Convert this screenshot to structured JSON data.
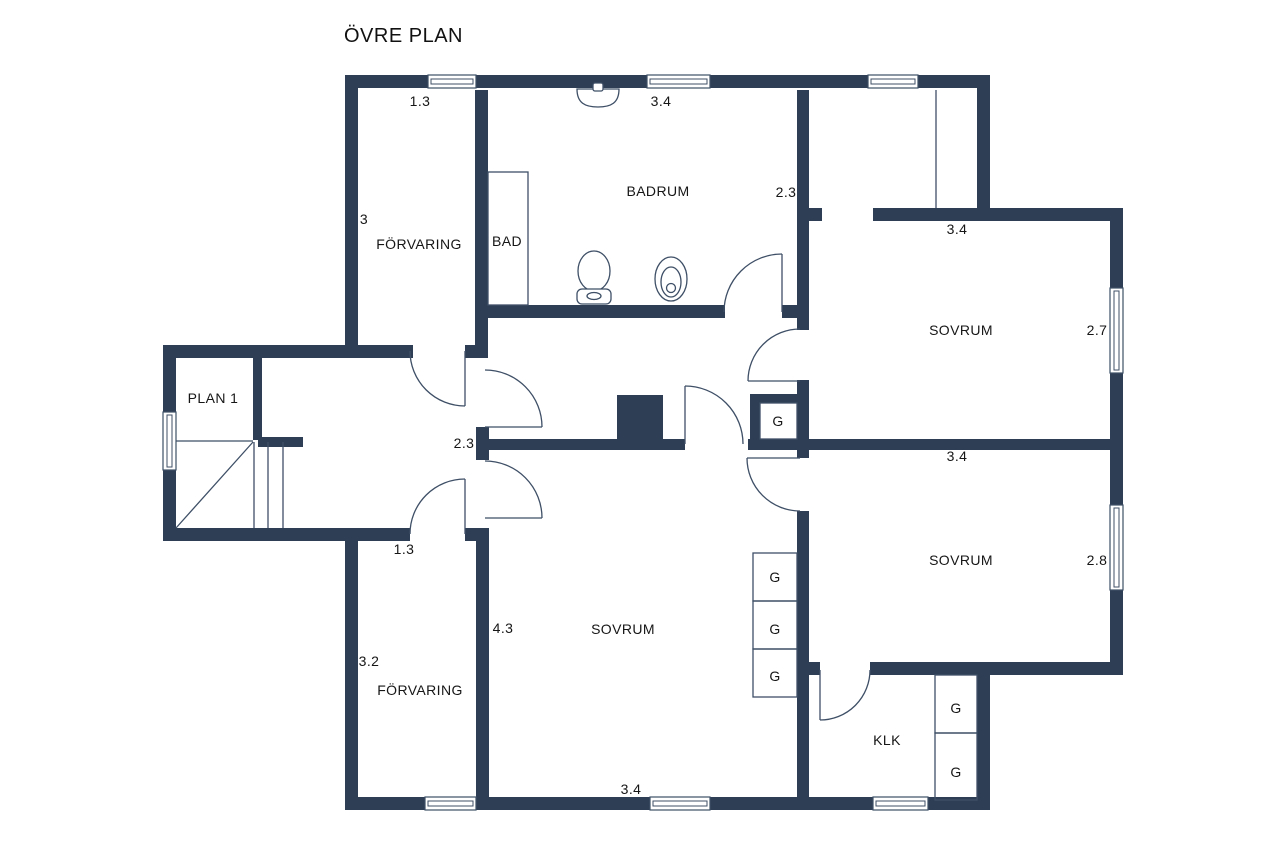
{
  "title": "ÖVRE PLAN",
  "rooms": [
    {
      "name": "FÖRVARING"
    },
    {
      "name": "BAD"
    },
    {
      "name": "BADRUM"
    },
    {
      "name": "SOVRUM"
    },
    {
      "name": "PLAN 1"
    },
    {
      "name": "SOVRUM"
    },
    {
      "name": "SOVRUM"
    },
    {
      "name": "FÖRVARING"
    },
    {
      "name": "KLK"
    }
  ],
  "dimensions": [
    {
      "value": "1.3"
    },
    {
      "value": "3.4"
    },
    {
      "value": "3"
    },
    {
      "value": "2.3"
    },
    {
      "value": "3.4"
    },
    {
      "value": "2.7"
    },
    {
      "value": "2.3"
    },
    {
      "value": "3.4"
    },
    {
      "value": "2.8"
    },
    {
      "value": "1.3"
    },
    {
      "value": "4.3"
    },
    {
      "value": "3.2"
    },
    {
      "value": "3.4"
    }
  ],
  "closets": [
    {
      "label": "G"
    },
    {
      "label": "G"
    },
    {
      "label": "G"
    },
    {
      "label": "G"
    },
    {
      "label": "G"
    },
    {
      "label": "G"
    }
  ],
  "symbols": [
    "window",
    "door-swing",
    "staircase",
    "chimney",
    "sink",
    "toilet",
    "bidet",
    "bathtub-area"
  ],
  "colors": {
    "wall": "#2e3f55",
    "line": "#3e4f66",
    "text": "#161616",
    "background": "#ffffff"
  }
}
